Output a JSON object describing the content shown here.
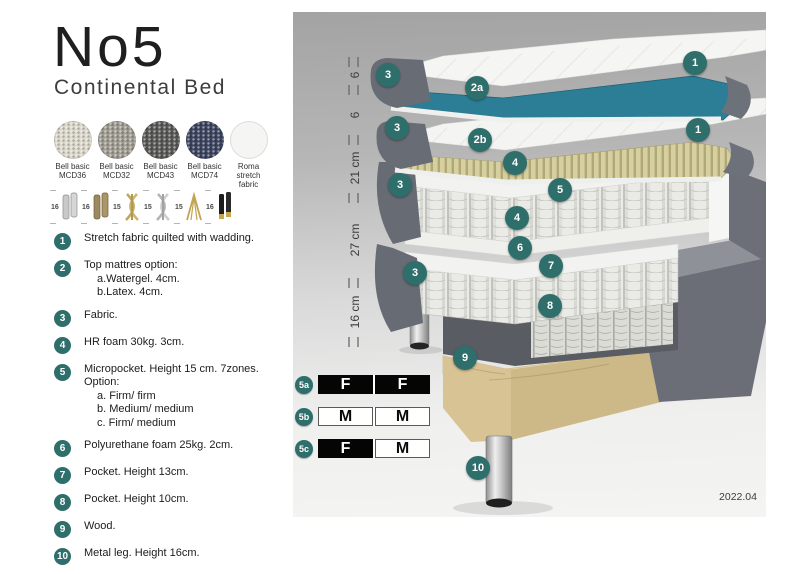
{
  "product": {
    "title": "No5",
    "subtitle": "Continental Bed"
  },
  "fabrics": [
    {
      "name": "Bell basic",
      "code": "MCD36",
      "color": "#dcd8cc"
    },
    {
      "name": "Bell basic",
      "code": "MCD32",
      "color": "#a19d93"
    },
    {
      "name": "Bell basic",
      "code": "MCD43",
      "color": "#595a58"
    },
    {
      "name": "Bell basic",
      "code": "MCD74",
      "color": "#3c4460"
    },
    {
      "name": "Roma",
      "code": "stretch fabric",
      "color": "#f5f5f4"
    }
  ],
  "legs": [
    {
      "height": "16",
      "type": "cylinder-silver"
    },
    {
      "height": "16",
      "type": "cylinder-bronze"
    },
    {
      "height": "15",
      "type": "twist-gold"
    },
    {
      "height": "15",
      "type": "twist-silver"
    },
    {
      "height": "15",
      "type": "hairpin-gold"
    },
    {
      "height": "16",
      "type": "cylinder-black-gold"
    }
  ],
  "features": [
    {
      "num": "1",
      "text": "Stretch fabric quilted with wadding.",
      "sub": []
    },
    {
      "num": "2",
      "text": "Top mattres option:",
      "sub": [
        "a.Watergel. 4cm.",
        "b.Latex. 4cm."
      ]
    },
    {
      "num": "3",
      "text": "Fabric.",
      "sub": []
    },
    {
      "num": "4",
      "text": "HR foam 30kg. 3cm.",
      "sub": []
    },
    {
      "num": "5",
      "text": "Micropocket. Height 15 cm. 7zones. Option:",
      "sub": [
        "a. Firm/ firm",
        "b. Medium/ medium",
        "c. Firm/ medium"
      ]
    },
    {
      "num": "6",
      "text": "Polyurethane foam 25kg. 2cm.",
      "sub": []
    },
    {
      "num": "7",
      "text": "Pocket. Height 13cm.",
      "sub": []
    },
    {
      "num": "8",
      "text": "Pocket. Height 10cm.",
      "sub": []
    },
    {
      "num": "9",
      "text": "Wood.",
      "sub": []
    },
    {
      "num": "10",
      "text": "Metal leg. Height 16cm.",
      "sub": []
    }
  ],
  "diagram": {
    "dimensions": [
      "6",
      "6",
      "21 cm",
      "27 cm",
      "16 cm"
    ],
    "badges": [
      "1",
      "3",
      "2a",
      "1",
      "3",
      "2b",
      "4",
      "3",
      "5",
      "4",
      "6",
      "7",
      "3",
      "8",
      "9",
      "10"
    ],
    "firmness_table": [
      {
        "label": "5a",
        "cells": [
          {
            "text": "F",
            "style": "dark"
          },
          {
            "text": "F",
            "style": "dark"
          }
        ]
      },
      {
        "label": "5b",
        "cells": [
          {
            "text": "M",
            "style": "light"
          },
          {
            "text": "M",
            "style": "light"
          }
        ]
      },
      {
        "label": "5c",
        "cells": [
          {
            "text": "F",
            "style": "dark"
          },
          {
            "text": "M",
            "style": "light"
          }
        ]
      }
    ],
    "version": "2022.04"
  },
  "colors": {
    "badge_teal": "#2e6e6b",
    "top_mattress_teal": "#2b7e95",
    "latex_beige": "#d6cf9f",
    "fabric_gray": "#686c75",
    "wood": "#e6d4a8"
  }
}
